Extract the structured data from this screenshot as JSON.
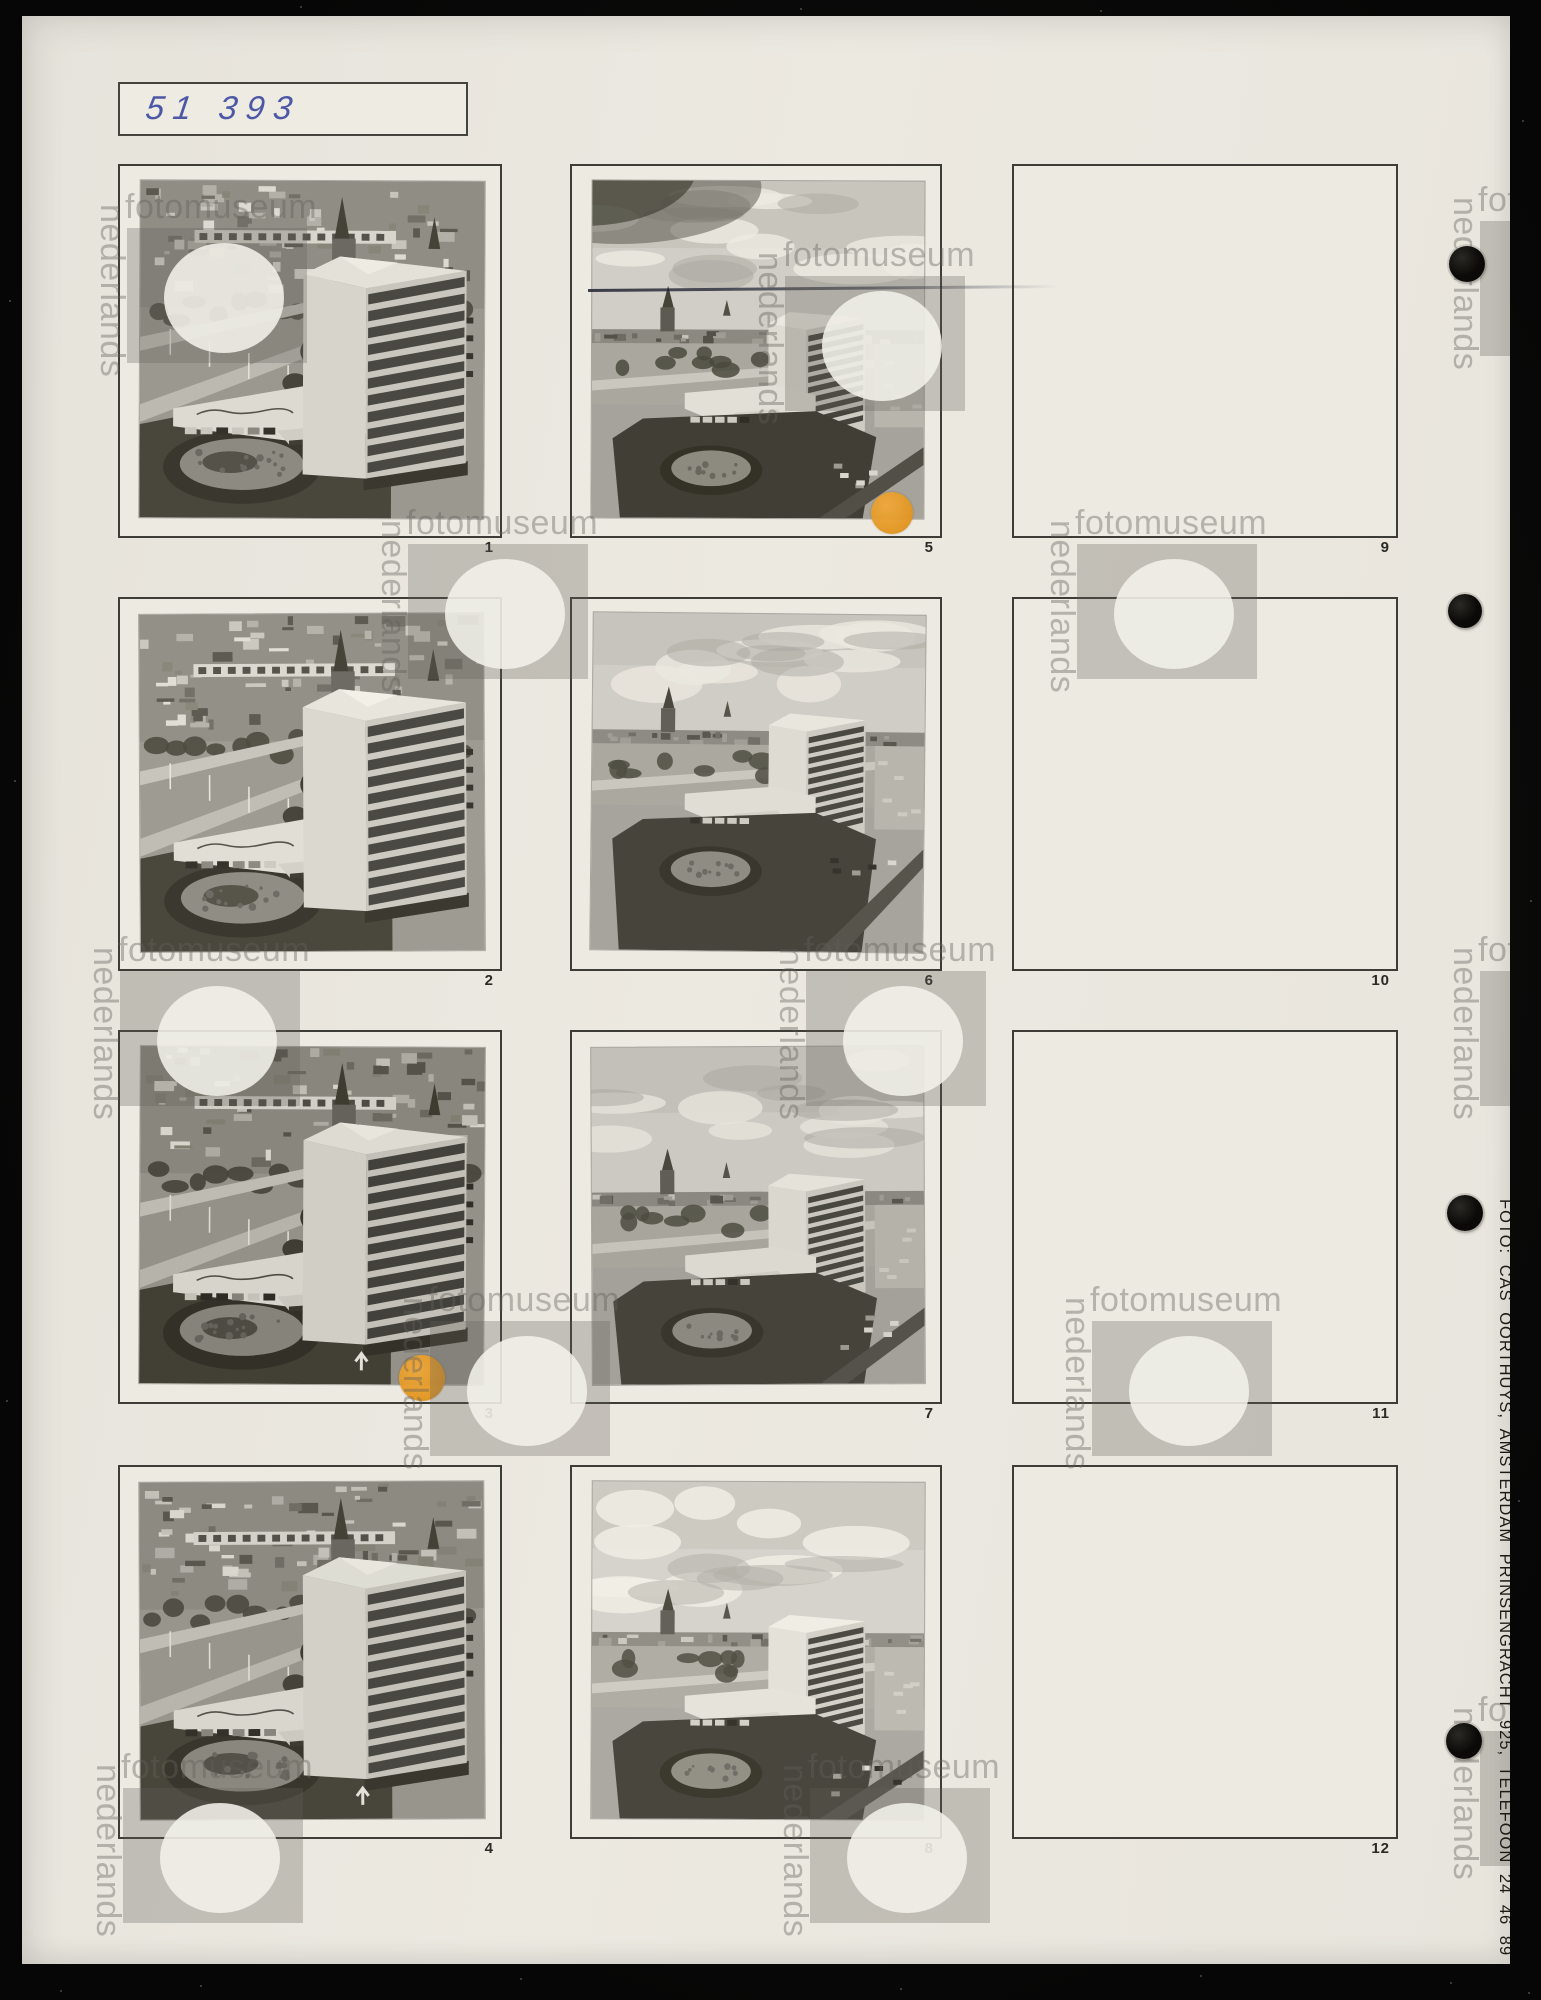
{
  "page": {
    "archive_number": "51 393",
    "subject": "Contact sheet album page with aerial photographs of a high-rise hotel building"
  },
  "credit": {
    "vertical_text": "FOTO: CAS OORTHUYS, AMSTERDAM PRINSENGRACHT 925, TELEFOON 24 46 89"
  },
  "watermark": {
    "word_vertical": "nederlands",
    "word_horizontal": "fotomuseum"
  },
  "grid": {
    "cells": [
      {
        "label": "1",
        "photo": {
          "variant": "close",
          "seed": 11,
          "arrow": false,
          "tone": "brightness(1)"
        }
      },
      {
        "label": "2",
        "photo": {
          "variant": "close",
          "seed": 23,
          "arrow": false,
          "tone": "brightness(1.02)"
        }
      },
      {
        "label": "3",
        "photo": {
          "variant": "close",
          "seed": 37,
          "arrow": true,
          "tone": "brightness(0.95) contrast(1.06)"
        }
      },
      {
        "label": "4",
        "photo": {
          "variant": "close",
          "seed": 51,
          "arrow": true,
          "tone": "brightness(0.98)"
        }
      },
      {
        "label": "5",
        "photo": {
          "variant": "wide",
          "seed": 67,
          "vignette": true,
          "horizon": 150,
          "tone": "contrast(1.07)"
        }
      },
      {
        "label": "6",
        "photo": {
          "variant": "wide",
          "seed": 79,
          "vignette": false,
          "horizon": 118,
          "tone": "brightness(1.02)"
        }
      },
      {
        "label": "7",
        "photo": {
          "variant": "wide",
          "seed": 93,
          "vignette": false,
          "horizon": 146,
          "tone": "brightness(1)"
        }
      },
      {
        "label": "8",
        "photo": {
          "variant": "wide",
          "seed": 108,
          "vignette": false,
          "horizon": 152,
          "tone": "brightness(1.05)"
        }
      },
      {
        "label": "9",
        "photo": null
      },
      {
        "label": "10",
        "photo": null
      },
      {
        "label": "11",
        "photo": null
      },
      {
        "label": "12",
        "photo": null
      }
    ]
  },
  "markers": [
    {
      "on_frame": "5",
      "x": 870,
      "y": 497,
      "r": 21,
      "color": "#e2951f"
    },
    {
      "on_frame": "3",
      "x": 400,
      "y": 1362,
      "r": 23,
      "color": "#e2951f"
    }
  ],
  "colors": {
    "page": "#e9e6de",
    "background": "#070707",
    "frame_border": "#3e3c36",
    "ink_blue": "#4c57a5",
    "marker_orange": "#e2951f"
  }
}
